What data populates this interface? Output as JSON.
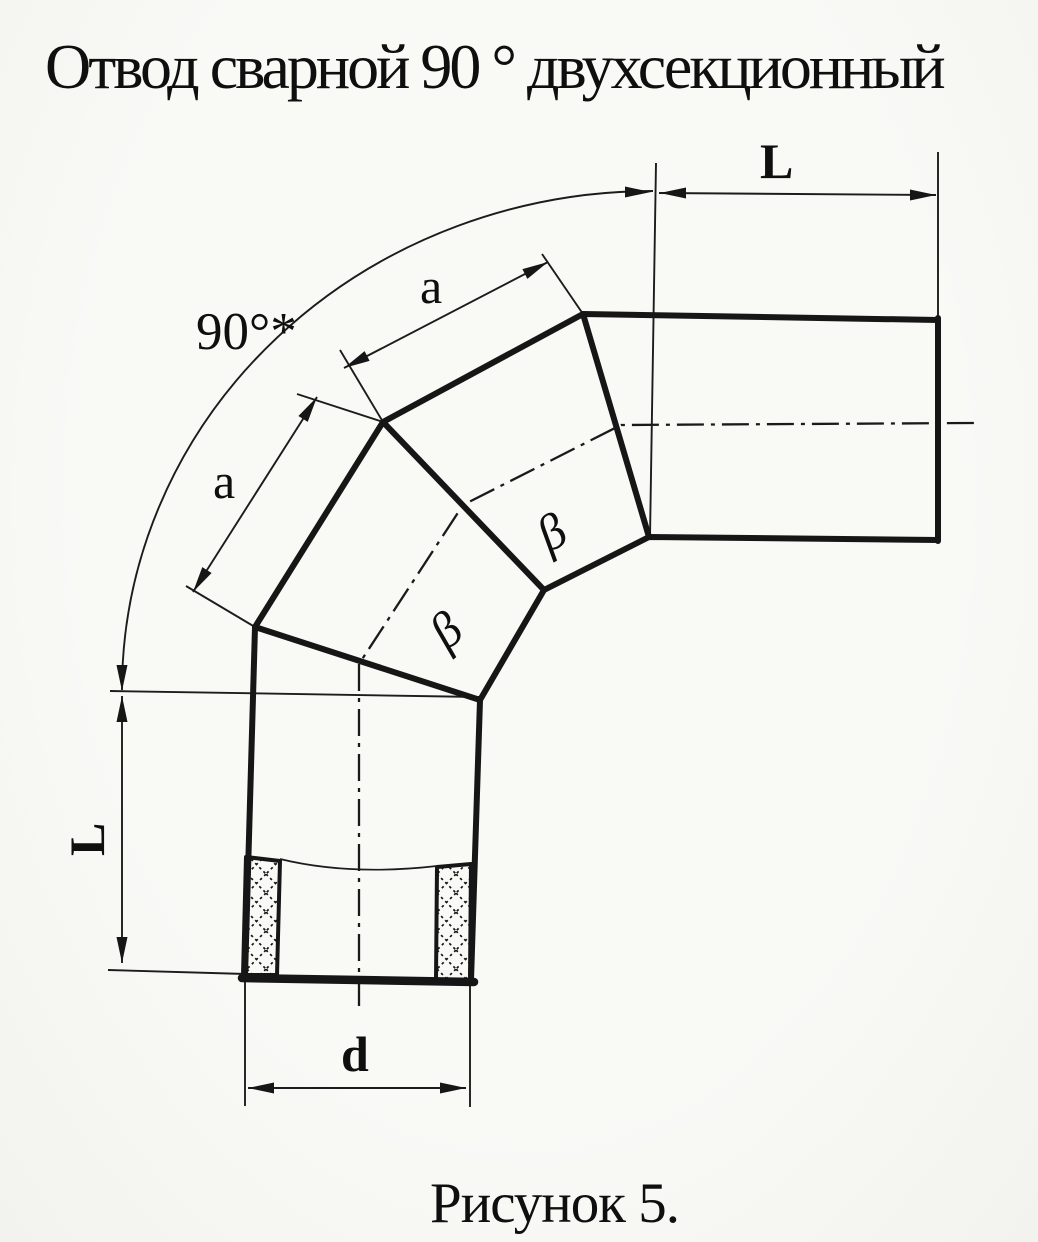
{
  "document": {
    "title": "Отвод сварной 90 ° двухсекционный",
    "caption": "Рисунок 5."
  },
  "drawing": {
    "labels": {
      "angle": "90°*",
      "length_top": "L",
      "length_left": "L",
      "section_length_upper": "a",
      "section_length_lower": "a",
      "diameter": "d",
      "bevel_angle_upper": "β",
      "bevel_angle_lower": "β"
    },
    "colors": {
      "ink": "#161616",
      "paper": "#f6f6f3"
    }
  }
}
